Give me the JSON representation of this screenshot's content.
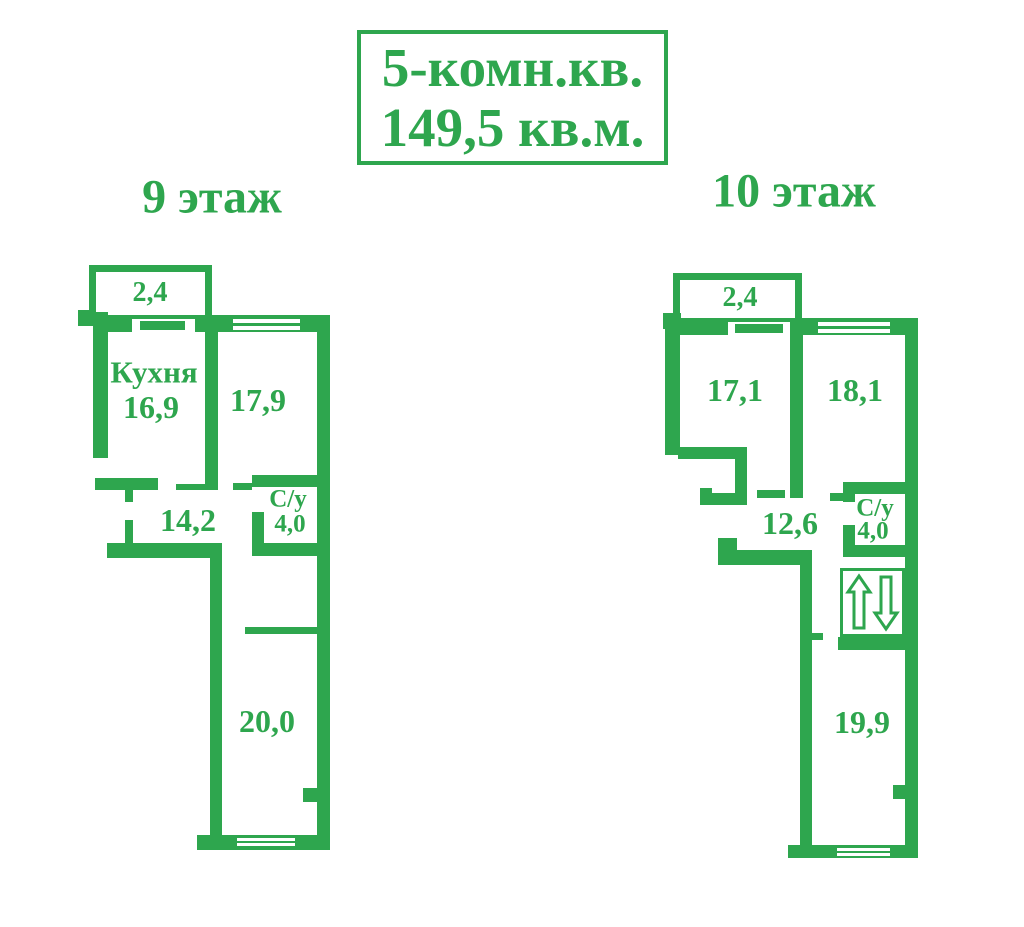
{
  "title": {
    "line1": "5-комн.кв.",
    "line2": "149,5 кв.м."
  },
  "floors": {
    "left": {
      "label": "9 этаж",
      "rooms": {
        "balcony_area": "2,4",
        "kitchen_name": "Кухня",
        "kitchen_area": "16,9",
        "room1_area": "17,9",
        "hall_area": "14,2",
        "bath_name": "С/у",
        "bath_area": "4,0",
        "room2_area": "20,0"
      }
    },
    "right": {
      "label": "10 этаж",
      "rooms": {
        "balcony_area": "2,4",
        "room1_area": "17,1",
        "room2_area": "18,1",
        "hall_area": "12,6",
        "bath_name": "С/у",
        "bath_area": "4,0",
        "room3_area": "19,9"
      }
    }
  },
  "icons": {
    "stairs": "up-down-arrows"
  },
  "colors": {
    "green": "#2EA64E",
    "background": "#FFFFFF"
  }
}
